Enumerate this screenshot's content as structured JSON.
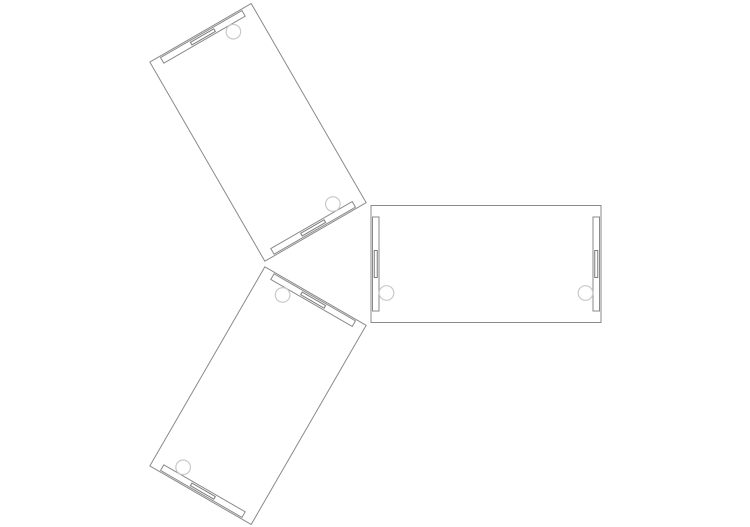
{
  "canvas": {
    "width": 750,
    "height": 527,
    "background": "#ffffff"
  },
  "drawing": {
    "type": "cad-plan-view",
    "description": "Three identical rectangular desk blocks arranged in a Y-shaped cluster, spaced 120 degrees apart around a central point, drawn as thin-line CAD plan view with edge strips, cable slots and grommet circles",
    "stroke_color": "#8a8a8a",
    "slot_stroke_color": "#7d7d7d",
    "grommet_stroke_color": "#c9c9c9",
    "stroke_width": 1,
    "cluster_center": {
      "x": 334,
      "y": 264
    },
    "inner_edge_offset": 37,
    "desk_block": {
      "length": 230,
      "width": 117,
      "edge_strip": {
        "inset_from_end": 1.5,
        "thickness": 6.5,
        "length": 94
      },
      "cable_slot": {
        "thickness": 3,
        "length": 27
      },
      "grommets": [
        {
          "along": 15.5,
          "across": 29,
          "radius": 7.3
        },
        {
          "along": 214.5,
          "across": 29,
          "radius": 7.3
        }
      ]
    },
    "desks": [
      {
        "name": "desk-block-upper-left",
        "rotation_deg": -120
      },
      {
        "name": "desk-block-right",
        "rotation_deg": 0
      },
      {
        "name": "desk-block-lower-left",
        "rotation_deg": 120
      }
    ]
  }
}
